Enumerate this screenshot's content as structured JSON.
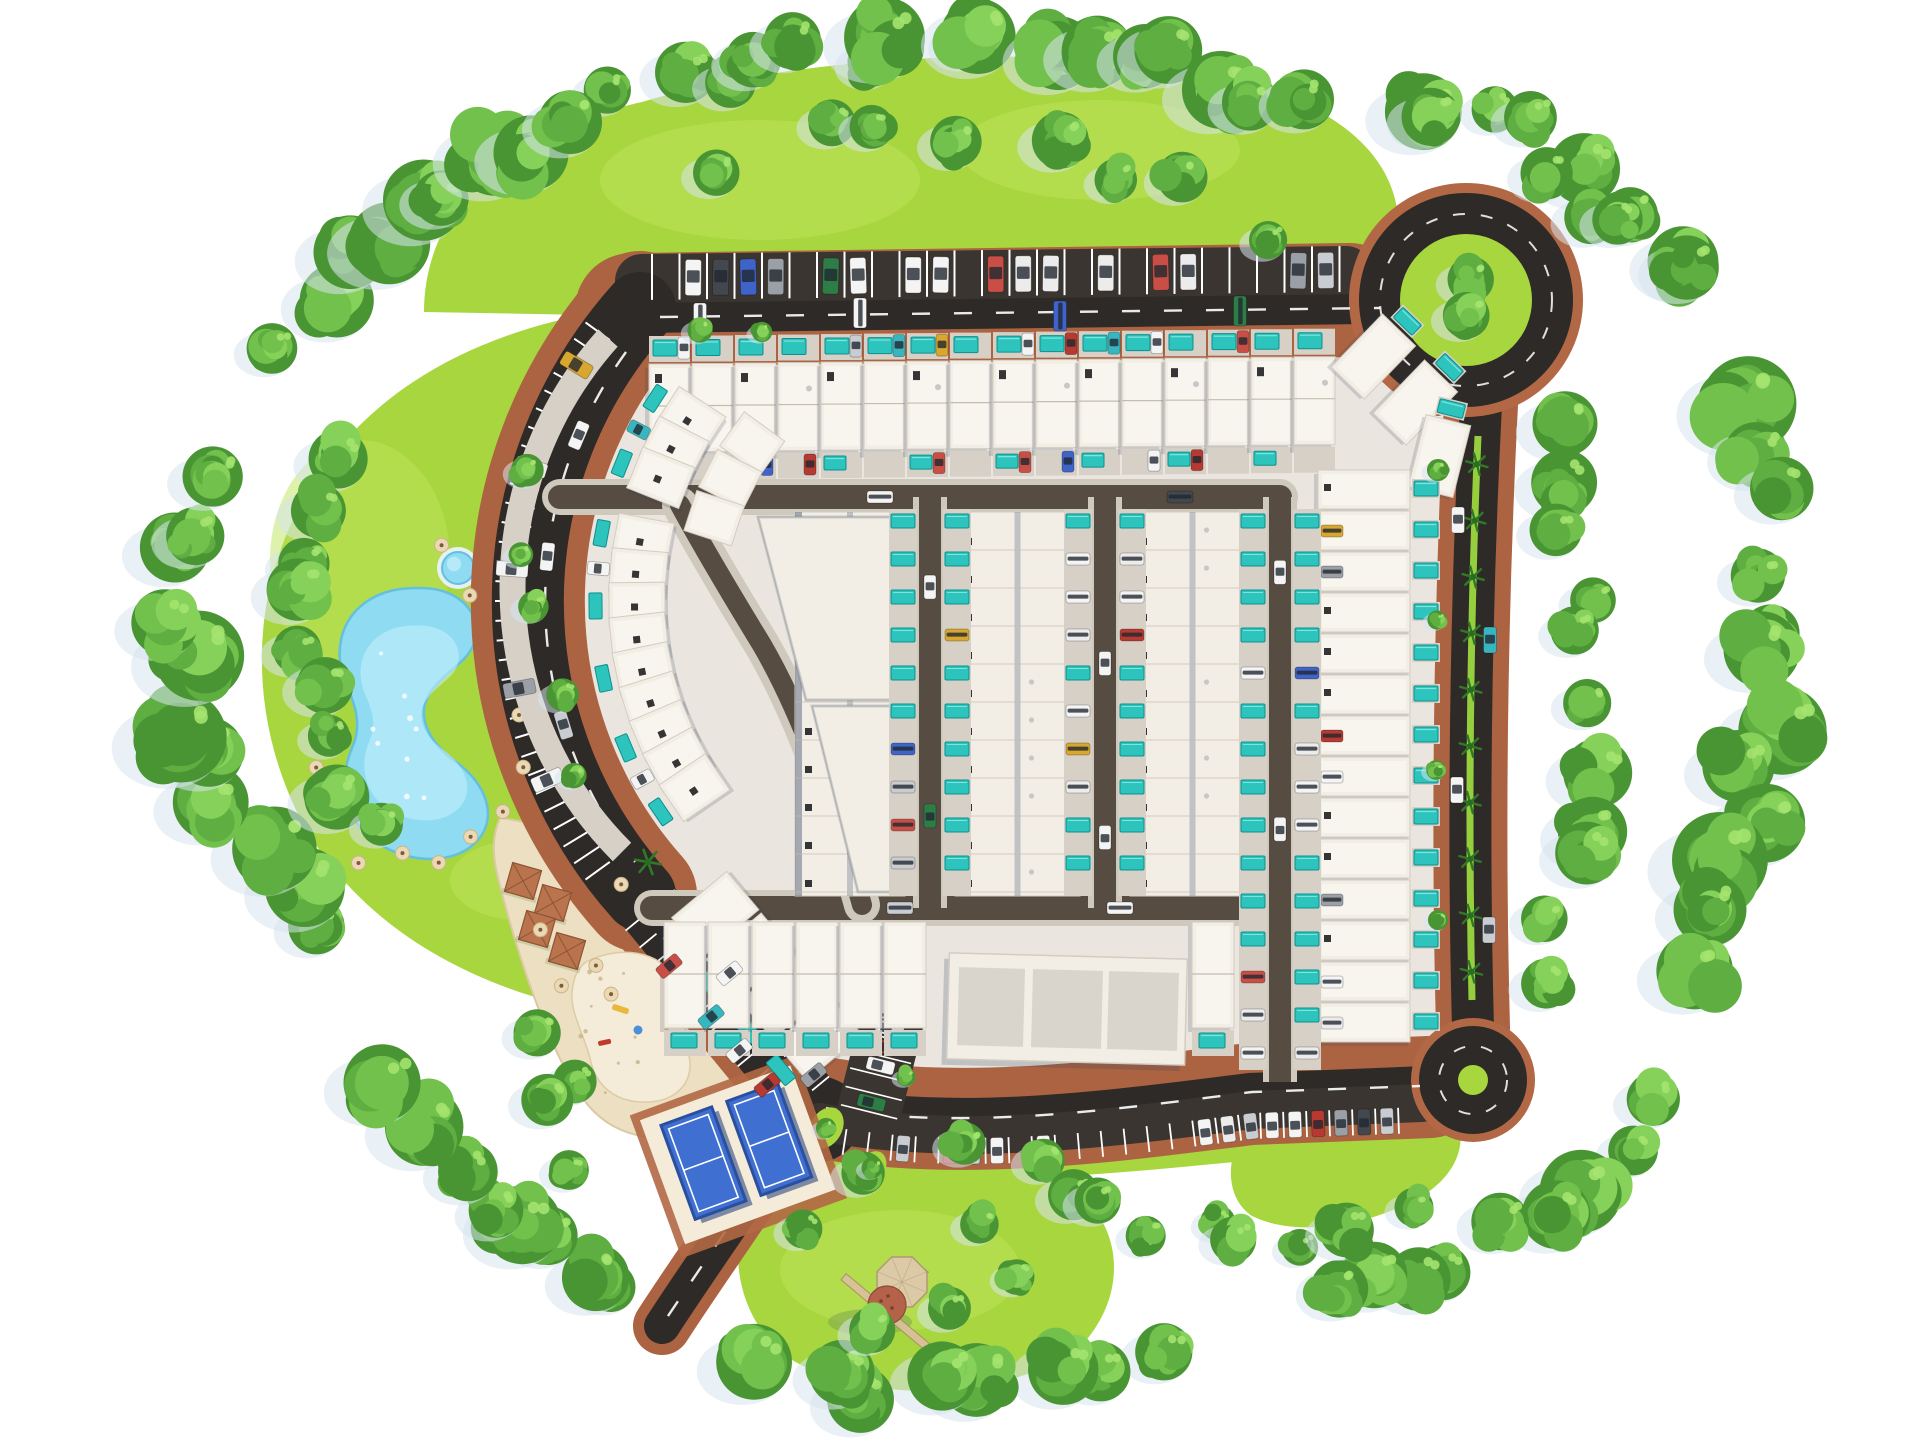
{
  "meta": {
    "title": "Aerial 3D master plan rendering of a gated residential community with townhouses, lagoon pool, beach club, tennis courts and loop road",
    "type": "3d-site-plan"
  },
  "features": [
    {
      "id": "lagoon-pool",
      "label": "Lagoon swimming pool"
    },
    {
      "id": "kids-pool",
      "label": "Round kids pool"
    },
    {
      "id": "beach-club",
      "label": "Sandy beach club with cabanas"
    },
    {
      "id": "playground",
      "label": "Sand playground"
    },
    {
      "id": "tennis-courts",
      "label": "Two blue sport courts"
    },
    {
      "id": "windmill",
      "label": "Windmill folly"
    },
    {
      "id": "roundabout-main",
      "label": "Main roundabout with green island"
    },
    {
      "id": "roundabout-small",
      "label": "Small roundabout"
    },
    {
      "id": "housing",
      "label": "Rows of white townhouses with turquoise plunge pools"
    },
    {
      "id": "parking",
      "label": "Perimeter parking stalls with cars"
    },
    {
      "id": "tree-belt",
      "label": "Perimeter landscape tree belt"
    }
  ],
  "palette": {
    "background": "#ffffff",
    "grass": "#a8d63f",
    "grass_light": "#bde35b",
    "grass_dark": "#8fc134",
    "tree1": "#4a9533",
    "tree2": "#5fae41",
    "tree3": "#73c14d",
    "tree4": "#86d159",
    "tree_hl": "#a4e36f",
    "tree_shadow": "#d7e4ee",
    "road": "#2d2a27",
    "road_band": "#3a3530",
    "road_internal": "#564c42",
    "street_side": "#cfc8bd",
    "brick": "#b26845",
    "brick_dark": "#8f4f30",
    "ground": "#eae6df",
    "sidewalk": "#d6d0c7",
    "house": "#f2eee6",
    "house_inner": "#f8f5ee",
    "house_stroke": "#d3ccc0",
    "seam": "#c4bcae",
    "navy": "#2f3f5e",
    "hatch": "#353535",
    "ac": "#c7c7c7",
    "pool": "#2cc4bc",
    "pool_dark": "#0f8f8d",
    "pool_hl": "#8ae8e2",
    "lagoon": "#8edbf2",
    "lagoon_hl": "#c9f0fb",
    "lagoon_stroke": "#64bfe0",
    "sand": "#ecdfc2",
    "sand_light": "#f4ecd8",
    "speck": "#c9b48b",
    "court": "#3f6fd0",
    "court_line": "#ffffff",
    "court_shadow": "#1e3a78",
    "court_frame": "#2b4f9f",
    "umbrella": "#ead9b4",
    "umbrella_dot": "#7a5c3c",
    "windmill_body": "#dcc9a6",
    "windmill_dome": "#b5624a",
    "windmill_blade": "#d9c09a",
    "median": "#96cf3d",
    "palm": "#2f7a26",
    "white": "#ffffff",
    "car_colors": [
      "#f4f4f4",
      "#ececec",
      "#c9ccd0",
      "#9aa0a6",
      "#b63a31",
      "#c94f46",
      "#3f63c8",
      "#2e7d46",
      "#d9a62e",
      "#38b6c0",
      "#43474e"
    ]
  },
  "scene": {
    "seed": 11,
    "canvas": {
      "w": 1920,
      "h": 1443
    },
    "grass": [
      {
        "d": "M 424,312 C 424,212 502,132 642,102 C 802,54 1062,40 1232,80 C 1332,102 1392,152 1398,216 C 1402,258 1388,292 1372,306 L 642,316 Z"
      },
      {
        "d": "M 650,305 C 480,322 362,392 302,502 C 247,602 250,722 302,822 C 352,912 442,972 552,1002 C 612,1018 652,1012 662,1002 L 644,898 C 525,800 472,702 472,602 C 472,482 542,362 650,305 Z"
      },
      {
        "d": "M 762,1180 C 852,1140 982,1140 1062,1180 C 1122,1216 1132,1290 1082,1345 C 1012,1400 872,1406 792,1360 C 732,1320 722,1232 762,1180 Z"
      },
      {
        "d": "M 1292,1096 C 1362,1088 1422,1092 1450,1112 C 1470,1132 1462,1172 1422,1196 C 1362,1230 1292,1236 1252,1216 C 1222,1196 1227,1150 1248,1124 Z"
      },
      {
        "d": "M 850,1152 C 1000,1180 1150,1154 1420,1130",
        "stroke": true,
        "w": 28
      }
    ],
    "ground": "M 640,306 L 1352,299 L 1452,398 L 1456,1062 L 1398,1096 C 1240,1112 1050,1130 900,1116 C 860,1112 830,1106 812,1100 L 648,900 A 440 440 0 0 1 640,306 Z",
    "lagoon": {
      "d": "M 420,588 C 455,588 478,608 476,634 C 474,660 448,668 432,690 C 414,714 428,742 456,762 C 486,784 498,816 478,840 C 455,866 408,864 376,842 C 344,820 338,780 352,748 C 362,726 356,706 346,684 C 334,656 338,622 366,602 C 384,590 400,588 420,588 Z",
      "hl_transform": "translate(116,202) scale(0.72)",
      "sparkle_box": [
        365,
        615,
        100,
        215
      ],
      "sparkles": 9
    },
    "kids_pool": {
      "cx": 458,
      "cy": 568,
      "r": 16
    },
    "sand": {
      "d": "M 500,818 C 560,824 610,862 628,896 L 780,1112 C 788,1126 780,1138 764,1136 L 700,1130 C 660,1146 612,1138 584,1100 C 548,1050 516,950 498,878 C 492,854 492,836 500,818 Z"
    },
    "playground": {
      "d": "M 586,962 C 620,945 660,950 676,980 C 692,1008 680,1030 688,1052 C 696,1078 680,1100 650,1102 C 615,1104 595,1085 590,1058 C 584,1035 570,1012 572,992 C 574,975 578,968 586,962 Z",
      "speck_box": [
        580,
        960,
        100,
        135
      ],
      "specks": 14
    },
    "cabanas": {
      "pts": [
        [
          523,
          881
        ],
        [
          553,
          903
        ],
        [
          537,
          929
        ],
        [
          567,
          951
        ]
      ],
      "size": 30,
      "rot": 16
    },
    "tennis": {
      "cx": 737,
      "cy": 1153,
      "rot": -20
    },
    "windmill": {
      "cx": 902,
      "cy": 1282,
      "dome_cx": 887,
      "dome_cy": 1305,
      "blade_cx": 888,
      "blade_cy": 1314,
      "blade_rot": 40
    },
    "junction_islands": [
      {
        "cx": 826,
        "cy": 1128,
        "rx": 16,
        "ry": 22,
        "rot": 30
      },
      {
        "cx": 872,
        "cy": 1168,
        "rx": 13,
        "ry": 18,
        "rot": 30
      }
    ],
    "arc": {
      "cx": 969,
      "cy": 601,
      "r": 440
    },
    "roads": {
      "brick": [
        {
          "d": "M 632,310 L 1350,300",
          "w": 114
        },
        {
          "d": "M 640,308 A 440 440 0 0 0 640,895",
          "w": 114
        },
        {
          "d": "M 640,896 L 812,1106",
          "w": 94
        },
        {
          "d": "M 812,1106 C 960,1134 1120,1110 1250,1094 L 1430,1087",
          "w": 102
        },
        {
          "d": "M 800,1118 C 752,1196 706,1258 662,1326",
          "w": 58
        },
        {
          "d": "M 1481,404 C 1470,620 1468,840 1473,1028",
          "w": 74
        },
        {
          "d": "M 1342,314 Q 1410,338 1438,408",
          "w": 16
        }
      ],
      "asphalt": [
        {
          "d": "M 642,281 L 1346,273",
          "w": 54,
          "c": "road_band"
        },
        {
          "d": "M 640,318 L 1366,309",
          "w": 30,
          "c": "road"
        },
        {
          "d": "M 640,308 A 440 440 0 0 0 640,895",
          "w": 72,
          "c": "road"
        },
        {
          "d": "M 640,896 L 812,1106",
          "w": 64,
          "c": "road"
        },
        {
          "d": "M 812,1106 C 960,1134 1120,1110 1250,1094 L 1426,1087",
          "w": 42,
          "c": "road"
        },
        {
          "d": "M 820,1122 C 966,1150 1124,1126 1252,1110 L 1422,1103",
          "w": 38,
          "c": "road_band"
        },
        {
          "d": "M 800,1118 C 752,1196 706,1258 662,1326",
          "w": 36,
          "c": "road"
        },
        {
          "d": "M 1481,404 C 1470,620 1468,840 1473,1028",
          "w": 42,
          "c": "road"
        }
      ],
      "junction_pad": "M 772,1076 C 806,1068 844,1076 856,1096 C 870,1118 860,1146 836,1158 C 810,1170 780,1162 766,1140 C 754,1120 756,1092 772,1076 Z",
      "lane_dashes": [
        "M 660,317 L 1380,308",
        "M 626,352 A 424 424 0 0 0 635,862",
        "M 648,906 L 806,1098",
        "M 826,1108 C 966,1132 1124,1108 1252,1092 L 1420,1086",
        "M 794,1126 C 748,1200 704,1262 664,1322"
      ]
    },
    "roundabouts": {
      "main": {
        "cx": 1466,
        "cy": 300,
        "r_brick": 117,
        "r_asphalt": 107,
        "r_grass": 66,
        "dash_r": 86
      },
      "small": {
        "cx": 1473,
        "cy": 1080,
        "r_brick": 62,
        "r_asphalt": 54,
        "r_grass": 15,
        "dash_r": 34
      }
    },
    "top_parking": {
      "x1": 652,
      "x2": 1340,
      "step": 27.5,
      "y_base": 254,
      "slope": -0.0113,
      "len": 46,
      "occupancy": 0.55
    },
    "arc_parking": {
      "t1": 216,
      "t2": 142,
      "step": 2.4,
      "r1": 444,
      "r2": 474,
      "car_r": 458,
      "car_th": [
        211,
        197,
        184,
        169,
        157
      ]
    },
    "beach_parking": {
      "p1": [
        640,
        898
      ],
      "p2": [
        812,
        1106
      ],
      "step": 22,
      "off1": 10,
      "off2": 32,
      "car_off": 21,
      "occ": 0.35
    },
    "bottom_parking": {
      "d": "M 824,1118 C 966,1146 1124,1122 1252,1106 L 1420,1100",
      "step": 23,
      "off1": 7,
      "off2": 33,
      "car_off": 20,
      "occ": 0.6
    },
    "right_road": {
      "median": "M 1478,436 C 1470,620 1468,820 1472,1000",
      "palms": 10,
      "cars": [
        [
          1458,
          520,
          0
        ],
        [
          1490,
          640,
          9
        ],
        [
          1457,
          790,
          0
        ],
        [
          1489,
          930,
          2
        ]
      ]
    },
    "small_lot": {
      "x": 862,
      "y": 1008,
      "rot": 14,
      "w": 64,
      "h": 108,
      "rows": 5
    },
    "internal": {
      "h1": "M 560,497 L 1280,497",
      "h2": "M 652,908 L 1280,908",
      "c1": "M 680,505 Q 710,560 762,645 Q 816,738 862,905",
      "streets": [
        930,
        1105,
        1280
      ],
      "street_y1": 497,
      "street_y2": 908,
      "v3_y2": 1082
    },
    "housing": {
      "b1": {
        "x0": 648,
        "n": 16,
        "uw": 43,
        "y": 334,
        "slope": -0.0113
      },
      "corner": [
        [
          1372,
          358,
          44
        ],
        [
          1414,
          404,
          44
        ],
        [
          1439,
          458,
          14
        ]
      ],
      "east": {
        "x": 1318,
        "y0": 470,
        "n": 14,
        "uh": 41
      },
      "south": {
        "xs": [
          664,
          708,
          752,
          796,
          840,
          884,
          1192
        ],
        "y": 922
      },
      "clubhouse": {
        "x": 948,
        "y": 956,
        "w": 238,
        "h": 106,
        "rot": 1.5
      },
      "columns": [
        [
          795,
          905
        ],
        [
          955,
          1080
        ],
        [
          1130,
          1255
        ]
      ],
      "col_y": 512,
      "col_h": 384,
      "unit": 38,
      "wedge": [
        "M 758,517 L 892,517 L 892,700 L 806,700 Z",
        "M 812,706 L 892,706 L 892,892 L 858,892 Z"
      ],
      "strip_pool_ratio": 0.62,
      "arc1": {
        "r": 332,
        "th1": 213,
        "step": 5.6,
        "n": 13,
        "skip": [
          192,
          200
        ],
        "w": 44,
        "h": 56,
        "deck_r": 374
      },
      "arc1b": {
        "ths": [
          216,
          207,
          198
        ],
        "r": 268,
        "w": 42,
        "h": 50
      },
      "sw": {
        "n": 4,
        "s0": 60,
        "ds": 54,
        "off": 48,
        "rot": 230,
        "w": 50,
        "h": 72
      }
    },
    "umbrellas": {
      "lagoon": {
        "cx": 420,
        "cy": 715,
        "n": 13,
        "th0": -80,
        "dth": 20,
        "rad": 150,
        "radx": 0.72
      },
      "sand": {
        "n": 8,
        "box": [
          520,
          880,
          160,
          210
        ]
      }
    },
    "palms_beach": [
      [
        648,
        862
      ],
      [
        694,
        930
      ]
    ],
    "bushes": [
      [
        1438,
        470
      ],
      [
        1437,
        620
      ],
      [
        1436,
        770
      ],
      [
        1438,
        920
      ],
      [
        700,
        330
      ],
      [
        762,
        332
      ],
      [
        826,
        1128
      ],
      [
        872,
        1168
      ],
      [
        906,
        1077
      ]
    ],
    "trees": {
      "belts": [
        {
          "pts": [
            [
              600,
              95
            ],
            [
              780,
              60
            ],
            [
              990,
              48
            ],
            [
              1180,
              72
            ],
            [
              1330,
              120
            ]
          ],
          "n": 16,
          "r": [
            26,
            46
          ]
        },
        {
          "pts": [
            [
              1380,
              95
            ],
            [
              1520,
              125
            ],
            [
              1640,
              205
            ],
            [
              1700,
              300
            ]
          ],
          "n": 9,
          "r": [
            26,
            44
          ]
        },
        {
          "pts": [
            [
              1735,
              380
            ],
            [
              1768,
              520
            ],
            [
              1775,
              680
            ],
            [
              1745,
              845
            ],
            [
              1662,
              985
            ]
          ],
          "n": 12,
          "r": [
            30,
            55
          ]
        },
        {
          "pts": [
            [
              1545,
              400
            ],
            [
              1575,
              560
            ],
            [
              1580,
              740
            ],
            [
              1565,
              900
            ],
            [
              1535,
              1005
            ]
          ],
          "n": 11,
          "r": [
            24,
            40
          ]
        },
        {
          "pts": [
            [
              1655,
              1080
            ],
            [
              1575,
              1190
            ],
            [
              1445,
              1270
            ],
            [
              1305,
              1318
            ]
          ],
          "n": 9,
          "r": [
            28,
            48
          ]
        },
        {
          "pts": [
            [
              1185,
              1338
            ],
            [
              1020,
              1388
            ],
            [
              858,
              1395
            ],
            [
              738,
              1360
            ]
          ],
          "n": 8,
          "r": [
            26,
            44
          ]
        },
        {
          "pts": [
            [
              1000,
              1170
            ],
            [
              1090,
              1205
            ],
            [
              1200,
              1235
            ],
            [
              1320,
              1240
            ],
            [
              1420,
              1225
            ]
          ],
          "n": 9,
          "r": [
            20,
            32
          ]
        },
        {
          "pts": [
            [
              640,
              1310
            ],
            [
              540,
              1252
            ],
            [
              450,
              1162
            ],
            [
              388,
              1060
            ]
          ],
          "n": 8,
          "r": [
            26,
            46
          ]
        },
        {
          "pts": [
            [
              330,
              960
            ],
            [
              248,
              850
            ],
            [
              190,
              718
            ],
            [
              180,
              578
            ],
            [
              232,
              452
            ]
          ],
          "n": 11,
          "r": [
            30,
            52
          ]
        },
        {
          "pts": [
            [
              278,
              352
            ],
            [
              360,
              250
            ],
            [
              472,
              170
            ],
            [
              580,
              122
            ]
          ],
          "n": 9,
          "r": [
            28,
            48
          ]
        },
        {
          "pts": [
            [
              352,
              420
            ],
            [
              300,
              522
            ],
            [
              292,
              640
            ],
            [
              332,
              762
            ],
            [
              402,
              862
            ]
          ],
          "n": 9,
          "r": [
            22,
            38
          ]
        },
        {
          "pts": [
            [
              700,
              172
            ],
            [
              862,
              130
            ],
            [
              1032,
              152
            ],
            [
              1200,
              192
            ],
            [
              1302,
              242
            ]
          ],
          "n": 8,
          "r": [
            20,
            34
          ]
        },
        {
          "pts": [
            [
              500,
              432
            ],
            [
              522,
              562
            ],
            [
              556,
              692
            ],
            [
              612,
              802
            ]
          ],
          "n": 5,
          "r": [
            14,
            22
          ]
        },
        {
          "pts": [
            [
              782,
              1238
            ],
            [
              846,
              1182
            ],
            [
              962,
              1142
            ],
            [
              1032,
              1262
            ],
            [
              938,
              1330
            ],
            [
              842,
              1332
            ]
          ],
          "n": 7,
          "r": [
            20,
            30
          ]
        },
        {
          "pts": [
            [
              598,
              1098
            ],
            [
              540,
              1040
            ],
            [
              602,
              1182
            ]
          ],
          "n": 4,
          "r": [
            22,
            32
          ]
        },
        {
          "pts": [
            [
              1450,
              282
            ],
            [
              1492,
              320
            ]
          ],
          "n": 2,
          "r": [
            22,
            27
          ]
        },
        {
          "pts": [
            [
              1560,
              160
            ],
            [
              1610,
              240
            ]
          ],
          "n": 3,
          "r": [
            26,
            36
          ]
        }
      ]
    }
  }
}
